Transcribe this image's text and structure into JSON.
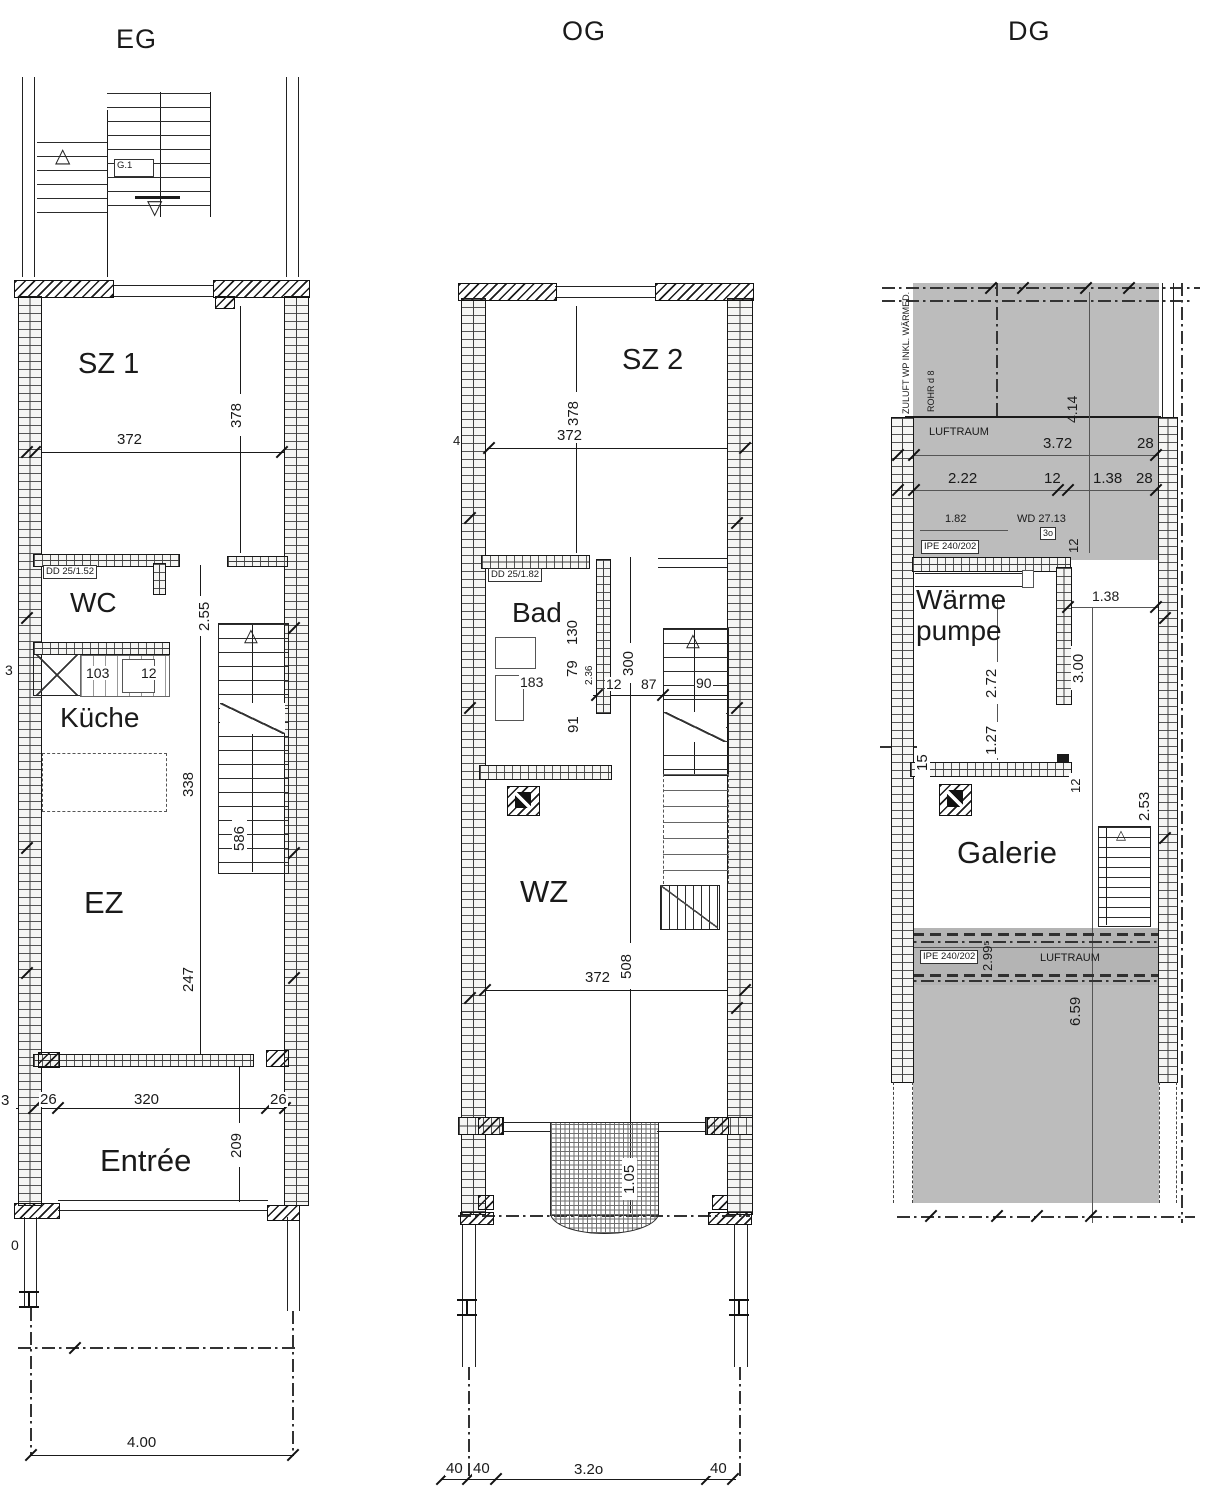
{
  "titles": {
    "eg": "EG",
    "og": "OG",
    "dg": "DG"
  },
  "icons": {
    "stair_up": "△",
    "stair_down": "▽"
  },
  "eg": {
    "stair_tag": "G.1",
    "room_sz1": "SZ 1",
    "room_wc": "WC",
    "room_kueche": "Küche",
    "room_ez": "EZ",
    "room_entree": "Entrée",
    "door_label": "DD 25/1.52",
    "dim_372": "372",
    "dim_378": "378",
    "dim_255": "2.55",
    "dim_103": "103",
    "dim_12": "12",
    "dim_338": "338",
    "dim_586": "586",
    "dim_247": "247",
    "dim_26l": "26",
    "dim_320": "320",
    "dim_26r": "26",
    "dim_209": "209",
    "dim_400": "4.00",
    "edge_3a": "3",
    "edge_3b": "3",
    "edge_0": "0"
  },
  "og": {
    "room_sz2": "SZ 2",
    "room_bad": "Bad",
    "room_wz": "WZ",
    "door_label": "DD 25/1.82",
    "dim_378": "378",
    "dim_372_top": "372",
    "dim_130": "130",
    "dim_79": "79",
    "dim_236": "2.36",
    "dim_300": "300",
    "dim_91": "91",
    "dim_183": "183",
    "dim_12": "12",
    "dim_87": "87",
    "dim_90": "90",
    "dim_508": "508",
    "dim_372_bottom": "372",
    "dim_105": "1.05",
    "dim_40a": "40",
    "dim_40b": "40",
    "dim_320": "3.2o",
    "dim_40c": "40",
    "edge_4": "4"
  },
  "dg": {
    "room_wp": "Wärme\npumpe",
    "room_galerie": "Galerie",
    "label_zuluft": "ZULUFT WP INKL. WÄRMED.",
    "label_rohr": "ROHR d 8",
    "label_luftraum_top": "LUFTRAUM",
    "label_luftraum_band": "LUFTRAUM",
    "label_ipe_top": "IPE 240/202",
    "label_ipe_band": "IPE 240/202",
    "label_wd": "WD 27.13",
    "label_3o": "3o",
    "dim_414": "4.14",
    "dim_372": "3.72",
    "dim_28a": "28",
    "dim_222": "2.22",
    "dim_12a": "12",
    "dim_138a": "1.38",
    "dim_28b": "28",
    "dim_182": "1.82",
    "dim_138b": "1.38",
    "dim_300": "3.00",
    "dim_272": "2.72",
    "dim_127": "1.27",
    "dim_15": "15",
    "dim_12b": "12",
    "dim_12c": "12",
    "dim_253": "2.53",
    "dim_2995": "2.99⁵",
    "dim_659": "6.59"
  }
}
